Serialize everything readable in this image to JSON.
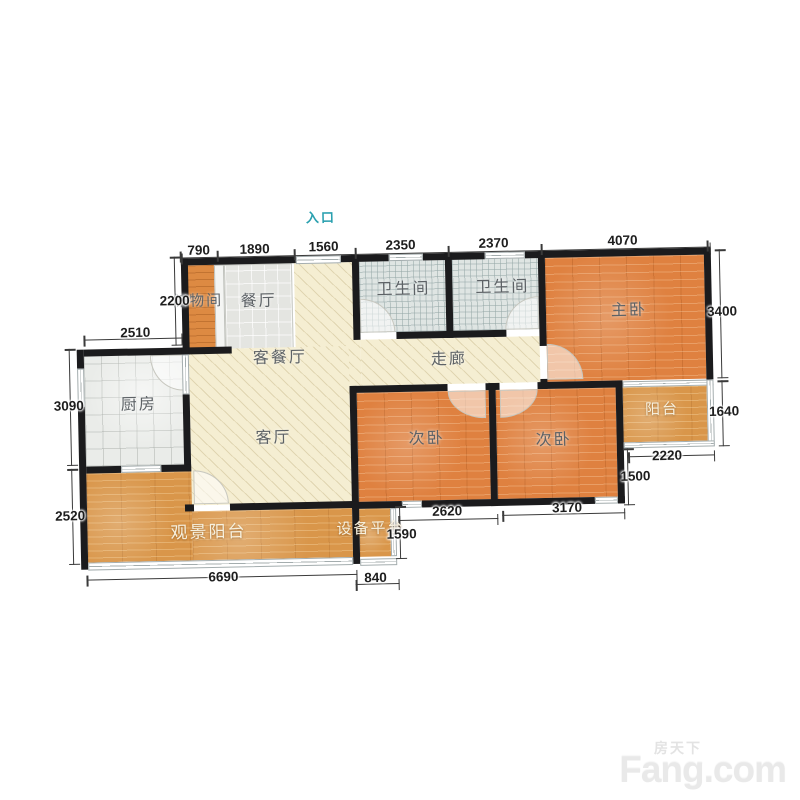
{
  "plan": {
    "entrance_label": "入口",
    "rooms": {
      "storage": "储物间",
      "dining": "餐厅",
      "living_dining": "客餐厅",
      "living": "客厅",
      "kitchen": "厨房",
      "corridor": "走廊",
      "bathroom1": "卫生间",
      "bathroom2": "卫生间",
      "master_bedroom": "主卧",
      "bedroom1": "次卧",
      "bedroom2": "次卧",
      "balcony": "阳台",
      "view_balcony": "观景阳台",
      "equipment_platform": "设备平台"
    },
    "dimensions": {
      "top": [
        "790",
        "1890",
        "1560",
        "2350",
        "2370",
        "4070"
      ],
      "left": [
        "2200",
        "2510",
        "3090",
        "2520"
      ],
      "right": [
        "3400",
        "1640"
      ],
      "bottom": [
        "6690",
        "840"
      ],
      "inner": [
        "1590",
        "2620",
        "3170",
        "2220",
        "1500"
      ]
    }
  },
  "watermark": {
    "cn": "房天下",
    "en": "Fang.com"
  },
  "colors": {
    "wall": "#1b1b1d",
    "wood": "#df8140",
    "wood_light": "#d9964a",
    "beige": "#f5eed2",
    "bath_tile": "#dfe5e3",
    "entrance_accent": "#2aa0af"
  }
}
